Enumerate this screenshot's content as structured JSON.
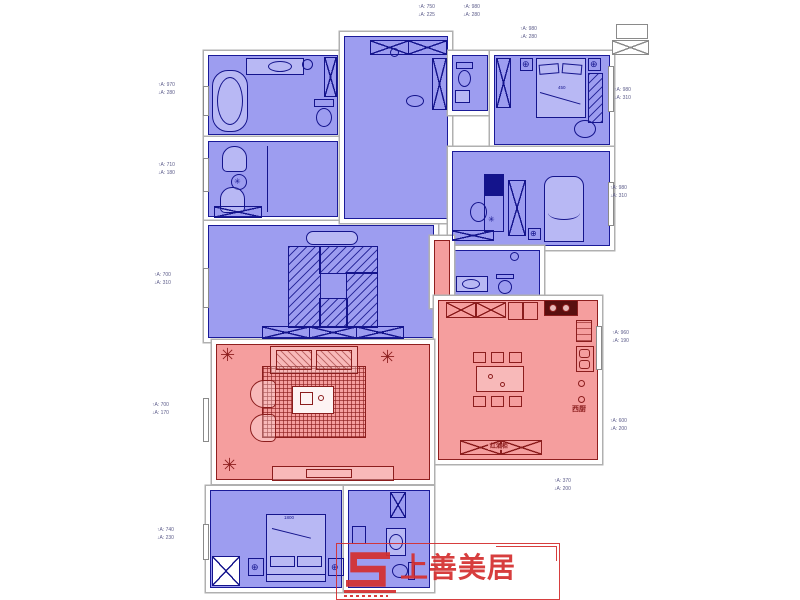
{
  "palette": {
    "room_blue": "#9d9df0",
    "line_blue": "#14148c",
    "room_red": "#f59e9e",
    "line_red": "#8b1d1d",
    "logo_red": "#d43030",
    "wall_gray": "#b0b0b0"
  },
  "watermark": {
    "brand_text": "上善美居",
    "mark_icon": "stylized-S-mark"
  },
  "plan_labels": {
    "west_kitchen": "西厨",
    "wine_cabinet": "红酒柜",
    "bed_size": "1800",
    "bedside_dim": "450"
  },
  "dim_annotations": [
    {
      "x": 418,
      "y": 3,
      "up": "↑A: 750",
      "dn": "↓A: 225"
    },
    {
      "x": 463,
      "y": 3,
      "up": "↑A: 980",
      "dn": "↓A: 280"
    },
    {
      "x": 520,
      "y": 25,
      "up": "↑A: 980",
      "dn": "↓A: 280"
    },
    {
      "x": 158,
      "y": 81,
      "up": "↑A: 970",
      "dn": "↓A: 280"
    },
    {
      "x": 158,
      "y": 161,
      "up": "↑A: 710",
      "dn": "↓A: 180"
    },
    {
      "x": 154,
      "y": 271,
      "up": "↑A: 700",
      "dn": "↓A: 310"
    },
    {
      "x": 152,
      "y": 401,
      "up": "↑A: 700",
      "dn": "↓A: 170"
    },
    {
      "x": 157,
      "y": 526,
      "up": "↑A: 740",
      "dn": "↓A: 230"
    },
    {
      "x": 614,
      "y": 86,
      "up": "↑A: 980",
      "dn": "↓A: 310"
    },
    {
      "x": 610,
      "y": 184,
      "up": "↑A: 980",
      "dn": "↓A: 310"
    },
    {
      "x": 612,
      "y": 329,
      "up": "↑A: 960",
      "dn": "↓A: 190"
    },
    {
      "x": 610,
      "y": 417,
      "up": "↑A: 600",
      "dn": "↓A: 200"
    },
    {
      "x": 554,
      "y": 477,
      "up": "↑A: 370",
      "dn": "↓A: 200"
    }
  ]
}
